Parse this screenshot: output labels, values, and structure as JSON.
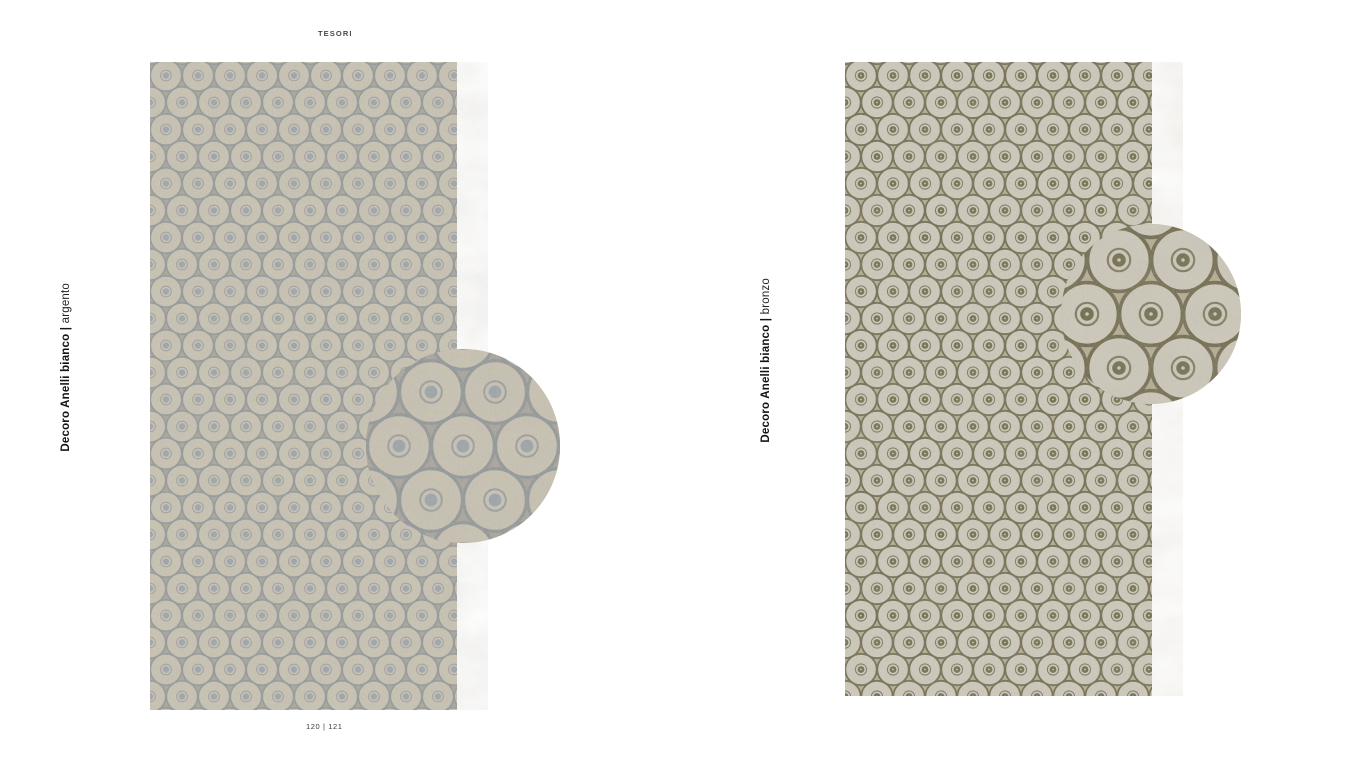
{
  "collection_title": "TESORI",
  "page_numbers": "120  |  121",
  "products": [
    {
      "name": "Decoro Anelli bianco",
      "separator": "|",
      "finish": "argento"
    },
    {
      "name": "Decoro Anelli bianco",
      "separator": "|",
      "finish": "bronzo"
    }
  ],
  "colors": {
    "left": {
      "gap": "#a6a299",
      "fill": "#c6c0b0",
      "ring": "#8e9496",
      "dot": "#99a1a8",
      "dotring": "#868f96"
    },
    "right": {
      "gap": "#b2a990",
      "fill": "#cac6b9",
      "ring": "#6d674c",
      "dot": "#6d674a",
      "dotcenter": "#c9c4b2"
    }
  }
}
